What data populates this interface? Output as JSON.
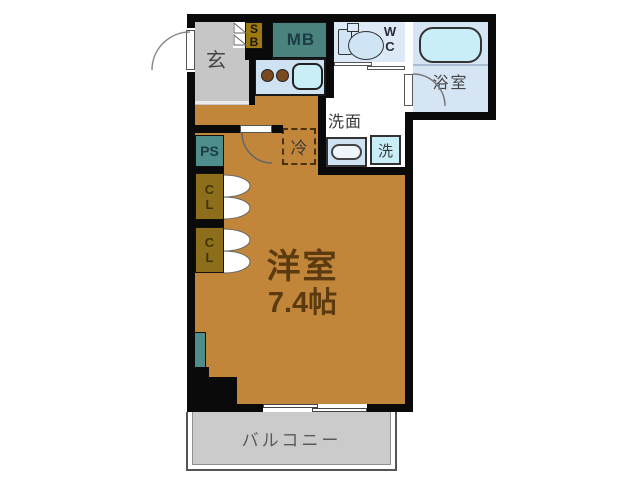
{
  "plan": {
    "entrance": {
      "label": "玄"
    },
    "shoe_box": {
      "label": "S\nB"
    },
    "meter_box": {
      "label": "MB"
    },
    "toilet": {
      "label": "W\nC"
    },
    "bathroom": {
      "label": "浴室"
    },
    "washroom": {
      "label": "洗面"
    },
    "washing_machine": {
      "label": "洗"
    },
    "refrigerator": {
      "label": "冷"
    },
    "pipe_space": {
      "label": "PS"
    },
    "closet_upper": {
      "label": "C\nL"
    },
    "closet_lower": {
      "label": "C\nL"
    },
    "western_room": {
      "name": "洋室",
      "size": "7.4帖"
    },
    "balcony": {
      "label": "バルコニー"
    }
  },
  "colors": {
    "wall": "#0a0a0a",
    "wood_floor": "#c1863a",
    "entrance_floor": "#c6c6c6",
    "balcony_floor": "#cbcbcb",
    "kitchen_counter": "#cfe2f2",
    "fixture_cyan": "#c9eef8",
    "wc_floor": "#dde9f6",
    "bathroom_floor": "#d5e5f4",
    "meter_box": "#4a827e",
    "pipe_space": "#4f8c8c",
    "shoe_box": "#9c7a10",
    "closet": "#8d6f1b",
    "room_text": "#5c3a10"
  }
}
